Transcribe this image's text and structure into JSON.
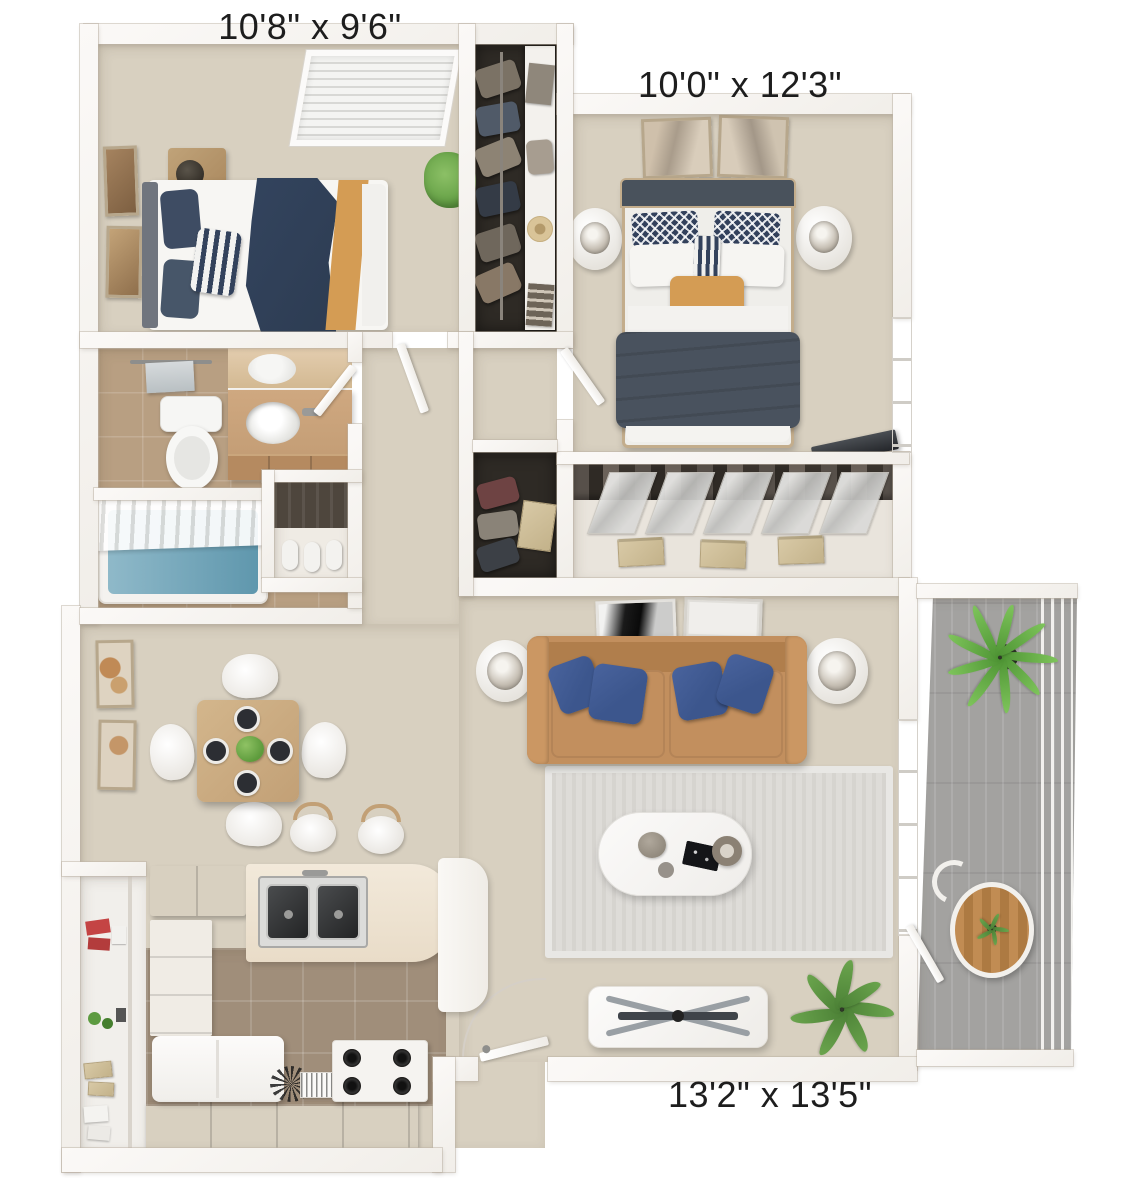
{
  "labels": {
    "bedroom_small": "10'8\" x 9'6\"",
    "bedroom_master": "10'0\" x 12'3\"",
    "living_room": "13'2\" x 13'5\""
  },
  "colors": {
    "wall": "#f1eee9",
    "carpet": "#d8d0c0",
    "closet_dark": "#2e2a25",
    "tile_bath": "#b89f82",
    "tile_kitchen": "#a08e7a",
    "deck": "#a3a2a0",
    "sofa": "#c28f5e",
    "sofa_dark": "#b07e4c",
    "pillow_blue": "#3c568d",
    "duvet_navy": "#49525e",
    "throw_navy": "#2d3c52",
    "accent_orange": "#d49c54",
    "wood": "#c8a67b",
    "plant": "#6aa44d",
    "plant_dark": "#4c8136",
    "label_text": "#1d1d1d"
  }
}
